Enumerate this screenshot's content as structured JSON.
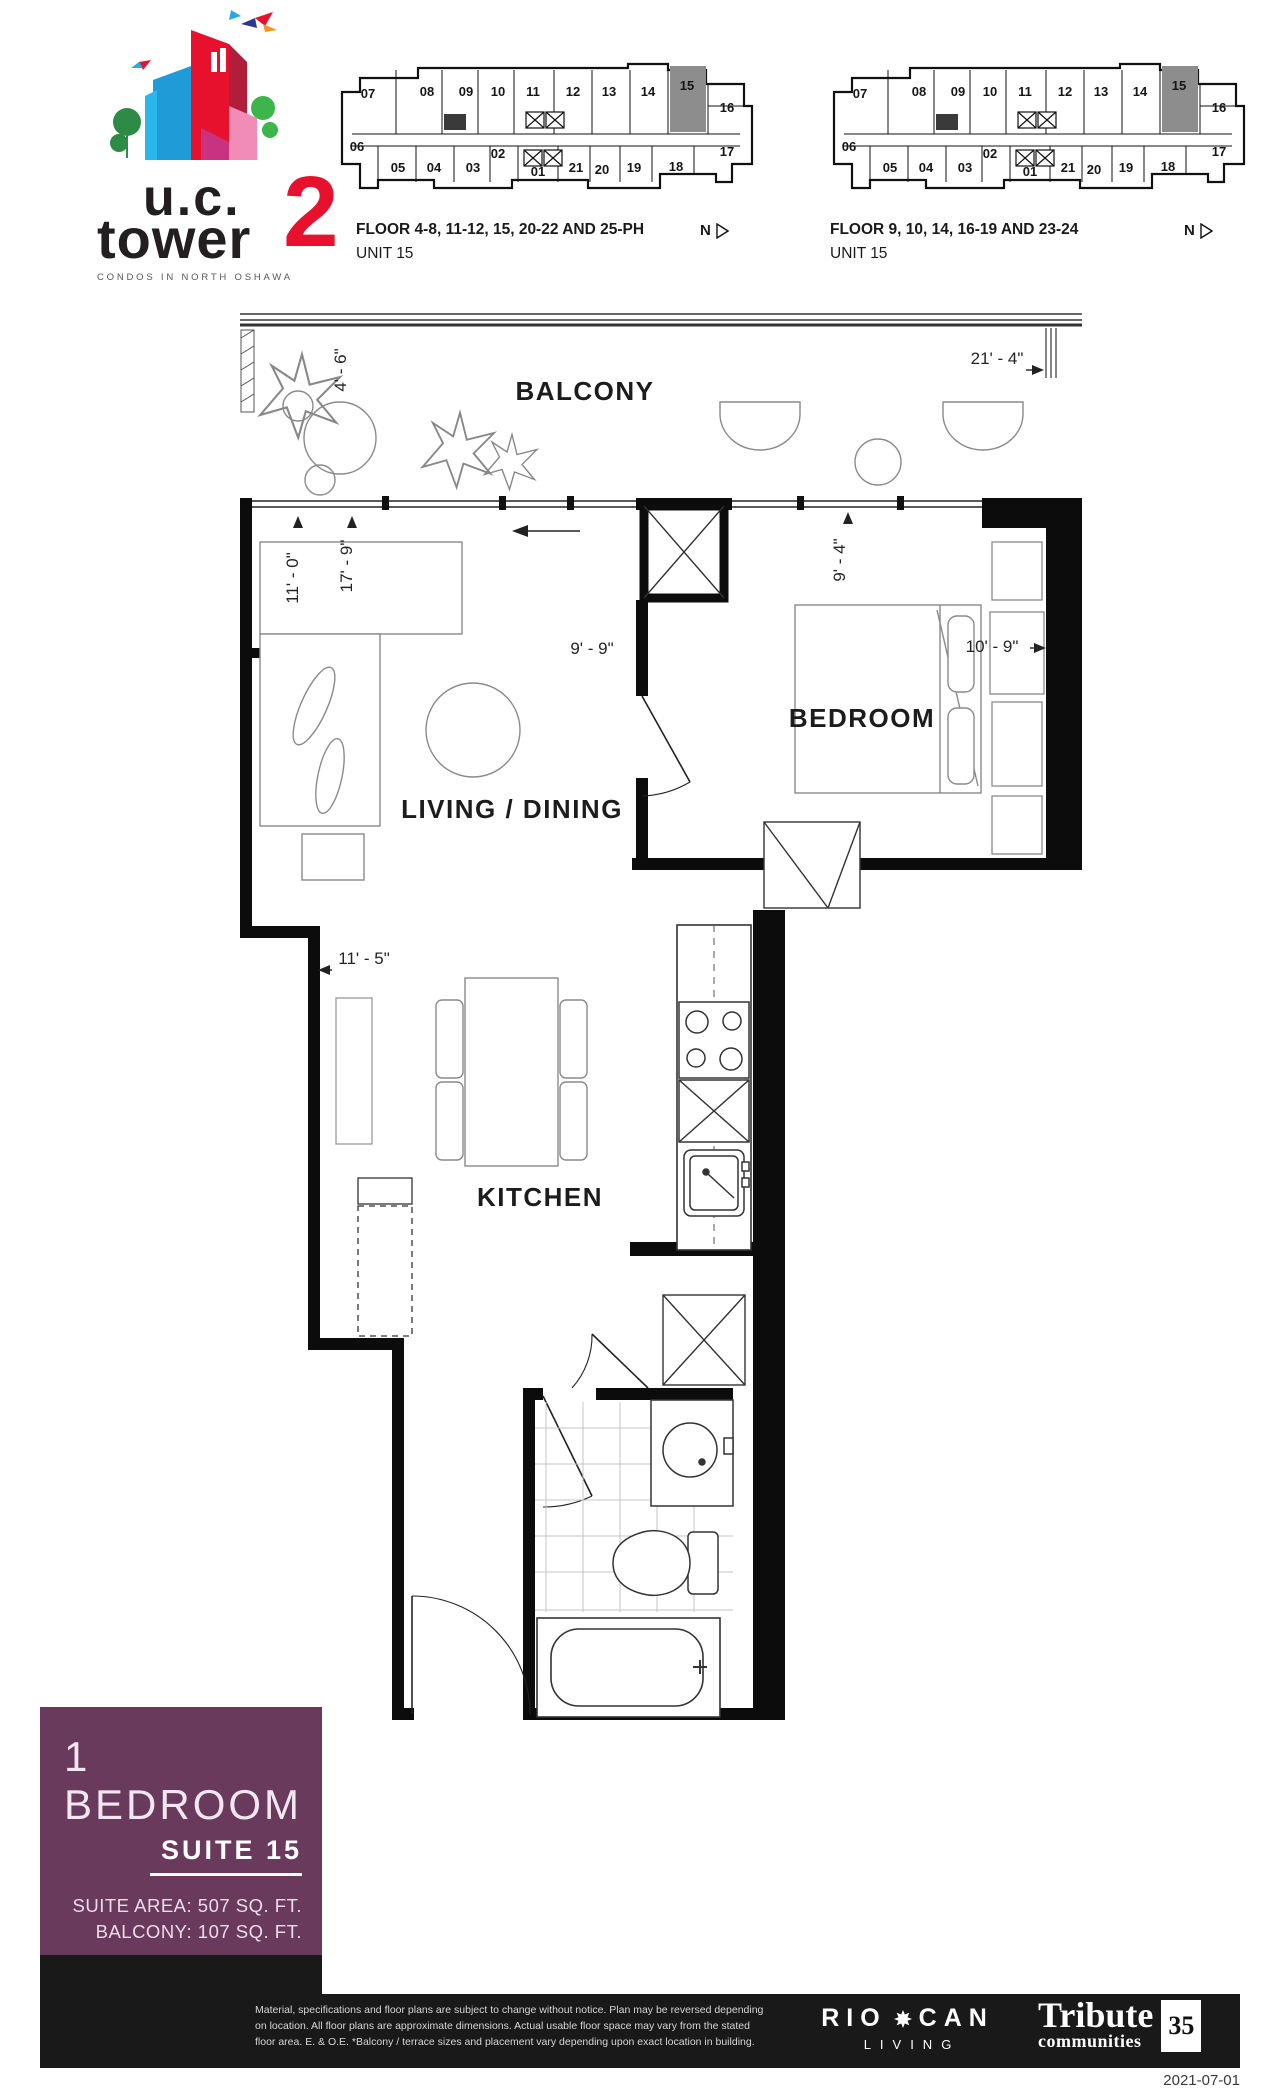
{
  "logo": {
    "line1": "u.c.",
    "line2": "tower",
    "number": "2",
    "tagline": "CONDOS IN NORTH OSHAWA"
  },
  "keyplans": [
    {
      "caption_line1": "FLOOR 4-8, 11-12, 15, 20-22 AND 25-PH",
      "caption_line2": "UNIT 15",
      "north_label": "N"
    },
    {
      "caption_line1": "FLOOR 9, 10, 14, 16-19 AND 23-24",
      "caption_line2": "UNIT 15",
      "north_label": "N"
    }
  ],
  "keyplan_units": {
    "highlight": "15",
    "units": [
      {
        "n": "07",
        "x": 38,
        "y": 46
      },
      {
        "n": "08",
        "x": 97,
        "y": 44
      },
      {
        "n": "09",
        "x": 136,
        "y": 44
      },
      {
        "n": "10",
        "x": 168,
        "y": 44
      },
      {
        "n": "11",
        "x": 203,
        "y": 44
      },
      {
        "n": "12",
        "x": 243,
        "y": 44
      },
      {
        "n": "13",
        "x": 279,
        "y": 44
      },
      {
        "n": "14",
        "x": 318,
        "y": 44
      },
      {
        "n": "15",
        "x": 357,
        "y": 38
      },
      {
        "n": "16",
        "x": 397,
        "y": 60
      },
      {
        "n": "17",
        "x": 397,
        "y": 104
      },
      {
        "n": "06",
        "x": 27,
        "y": 99
      },
      {
        "n": "05",
        "x": 68,
        "y": 120
      },
      {
        "n": "04",
        "x": 104,
        "y": 120
      },
      {
        "n": "03",
        "x": 143,
        "y": 120
      },
      {
        "n": "02",
        "x": 168,
        "y": 106
      },
      {
        "n": "01",
        "x": 208,
        "y": 124
      },
      {
        "n": "21",
        "x": 246,
        "y": 120
      },
      {
        "n": "20",
        "x": 272,
        "y": 122
      },
      {
        "n": "19",
        "x": 304,
        "y": 120
      },
      {
        "n": "18",
        "x": 346,
        "y": 119
      }
    ]
  },
  "floorplan": {
    "rooms": {
      "balcony": "BALCONY",
      "living": "LIVING / DINING",
      "bedroom": "BEDROOM",
      "kitchen": "KITCHEN"
    },
    "dims": {
      "balcony_width": "21' - 4\"",
      "balcony_depth": "4' - 6\"",
      "living_d1": "11' - 0\"",
      "living_d2": "17' - 9\"",
      "living_w": "9' - 9\"",
      "bedroom_d": "9' - 4\"",
      "bedroom_w": "10' - 9\"",
      "kitchen_w": "11' - 5\""
    }
  },
  "infobox": {
    "type": "1 BEDROOM",
    "suite": "SUITE 15",
    "area_line": "SUITE AREA: 507 SQ. FT.",
    "balcony_line": "BALCONY: 107 SQ. FT."
  },
  "footer": {
    "disclaimer_line1": "Material, specifications and floor plans are subject to change without notice.  Plan may be reversed depending",
    "disclaimer_line2": "on location. All floor plans are approximate dimensions. Actual usable floor space may vary from the stated",
    "disclaimer_line3": "floor area.  E. & O.E.  *Balcony / terrace sizes and placement vary depending upon exact location in building.",
    "riocan_left": "RIO",
    "riocan_right": "CAN",
    "riocan_sub": "LIVING",
    "tribute_name": "Tribute",
    "tribute_sub": "communities",
    "tribute_badge": "35",
    "date": "2021-07-01"
  }
}
